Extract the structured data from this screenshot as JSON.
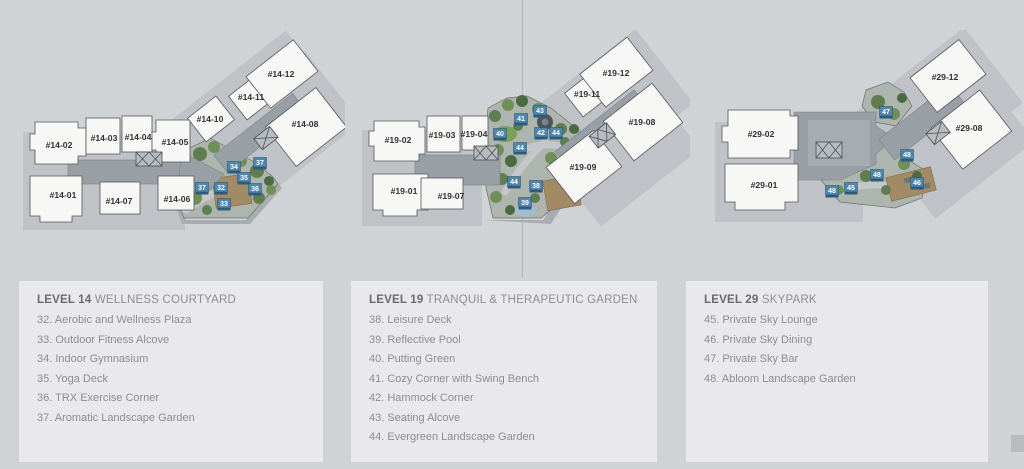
{
  "colors": {
    "background": "#d0d3d6",
    "panel": "#e9e9eb",
    "marker_blue_top": "#4e86ad",
    "marker_blue_front": "#2f5d7d",
    "building_white": "#f7f7f5",
    "corridor_gray": "#98a0a5"
  },
  "plans": [
    {
      "id": "level-14",
      "units": [
        {
          "label": "#14-02",
          "x": 49,
          "y": 118
        },
        {
          "label": "#14-03",
          "x": 94,
          "y": 111
        },
        {
          "label": "#14-04",
          "x": 128,
          "y": 110
        },
        {
          "label": "#14-05",
          "x": 165,
          "y": 115
        },
        {
          "label": "#14-01",
          "x": 53,
          "y": 168
        },
        {
          "label": "#14-07",
          "x": 109,
          "y": 174
        },
        {
          "label": "#14-06",
          "x": 167,
          "y": 172
        },
        {
          "label": "#14-10",
          "x": 200,
          "y": 92
        },
        {
          "label": "#14-11",
          "x": 241,
          "y": 70
        },
        {
          "label": "#14-12",
          "x": 271,
          "y": 47
        },
        {
          "label": "#14-08",
          "x": 295,
          "y": 97
        }
      ],
      "markers": [
        {
          "n": "34",
          "x": 224,
          "y": 137
        },
        {
          "n": "37",
          "x": 250,
          "y": 133
        },
        {
          "n": "35",
          "x": 234,
          "y": 148
        },
        {
          "n": "37",
          "x": 192,
          "y": 158
        },
        {
          "n": "32",
          "x": 211,
          "y": 158
        },
        {
          "n": "36",
          "x": 245,
          "y": 159
        },
        {
          "n": "33",
          "x": 214,
          "y": 174
        }
      ]
    },
    {
      "id": "level-19",
      "units": [
        {
          "label": "#19-02",
          "x": 43,
          "y": 113
        },
        {
          "label": "#19-03",
          "x": 87,
          "y": 108
        },
        {
          "label": "#19-04",
          "x": 119,
          "y": 107
        },
        {
          "label": "#19-01",
          "x": 49,
          "y": 164
        },
        {
          "label": "#19-07",
          "x": 96,
          "y": 169
        },
        {
          "label": "#19-11",
          "x": 232,
          "y": 67
        },
        {
          "label": "#19-12",
          "x": 261,
          "y": 46
        },
        {
          "label": "#19-08",
          "x": 287,
          "y": 95
        },
        {
          "label": "#19-09",
          "x": 228,
          "y": 140
        }
      ],
      "markers": [
        {
          "n": "43",
          "x": 185,
          "y": 81
        },
        {
          "n": "41",
          "x": 166,
          "y": 89
        },
        {
          "n": "40",
          "x": 145,
          "y": 104
        },
        {
          "n": "42",
          "x": 186,
          "y": 103
        },
        {
          "n": "44",
          "x": 201,
          "y": 103
        },
        {
          "n": "44",
          "x": 165,
          "y": 118
        },
        {
          "n": "44",
          "x": 159,
          "y": 152
        },
        {
          "n": "38",
          "x": 181,
          "y": 156
        },
        {
          "n": "39",
          "x": 170,
          "y": 173
        }
      ]
    },
    {
      "id": "level-29",
      "units": [
        {
          "label": "#29-02",
          "x": 71,
          "y": 107
        },
        {
          "label": "#29-01",
          "x": 74,
          "y": 158
        },
        {
          "label": "#29-12",
          "x": 255,
          "y": 50
        },
        {
          "label": "#29-08",
          "x": 279,
          "y": 101
        }
      ],
      "markers": [
        {
          "n": "47",
          "x": 196,
          "y": 82
        },
        {
          "n": "48",
          "x": 217,
          "y": 125
        },
        {
          "n": "48",
          "x": 187,
          "y": 145
        },
        {
          "n": "46",
          "x": 227,
          "y": 153
        },
        {
          "n": "45",
          "x": 161,
          "y": 158
        },
        {
          "n": "48",
          "x": 142,
          "y": 161
        }
      ]
    }
  ],
  "legends": [
    {
      "level": "LEVEL 14",
      "name": "WELLNESS COURTYARD",
      "items": [
        "32. Aerobic and Wellness Plaza",
        "33. Outdoor Fitness Alcove",
        "34. Indoor Gymnasium",
        "35. Yoga Deck",
        "36. TRX Exercise Corner",
        "37. Aromatic Landscape Garden"
      ]
    },
    {
      "level": "LEVEL 19",
      "name": "TRANQUIL & THERAPEUTIC GARDEN",
      "items": [
        "38. Leisure Deck",
        "39. Reflective Pool",
        "40. Putting Green",
        "41. Cozy Corner with Swing Bench",
        "42. Hammock Corner",
        "43. Seating Alcove",
        "44. Evergreen Landscape Garden"
      ]
    },
    {
      "level": "LEVEL 29",
      "name": "SKYPARK",
      "items": [
        "45. Private Sky Lounge",
        "46. Private Sky Dining",
        "47. Private Sky Bar",
        "48. Abloom Landscape Garden"
      ]
    }
  ]
}
